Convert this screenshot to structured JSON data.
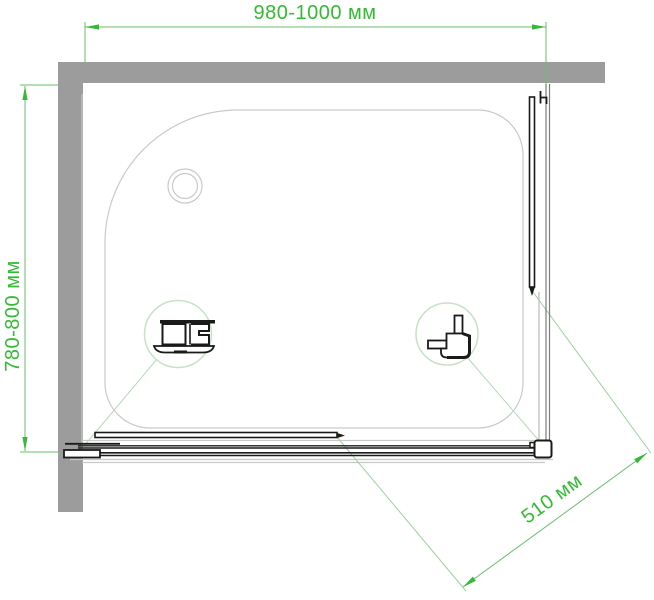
{
  "drawing": {
    "type": "shower-enclosure-top-view-dimension-drawing",
    "dimensions": {
      "width_label": "980-1000 мм",
      "depth_label": "780-800 мм",
      "opening_label": "510 мм"
    },
    "colors": {
      "dimension_green": "#33bb33",
      "dimension_line_green": "#6abf6a",
      "extension_line_green": "#9ed19e",
      "detail_circle_green": "#c6e2c6",
      "wall_gray": "#9c9c9c",
      "tray_line_gray": "#c9c9c9",
      "profile_black": "#1a1a1a"
    },
    "icons": {
      "drain": "drain-icon",
      "left_detail": "bottom-rail-profile-detail-icon",
      "right_detail": "corner-profile-detail-icon"
    }
  }
}
